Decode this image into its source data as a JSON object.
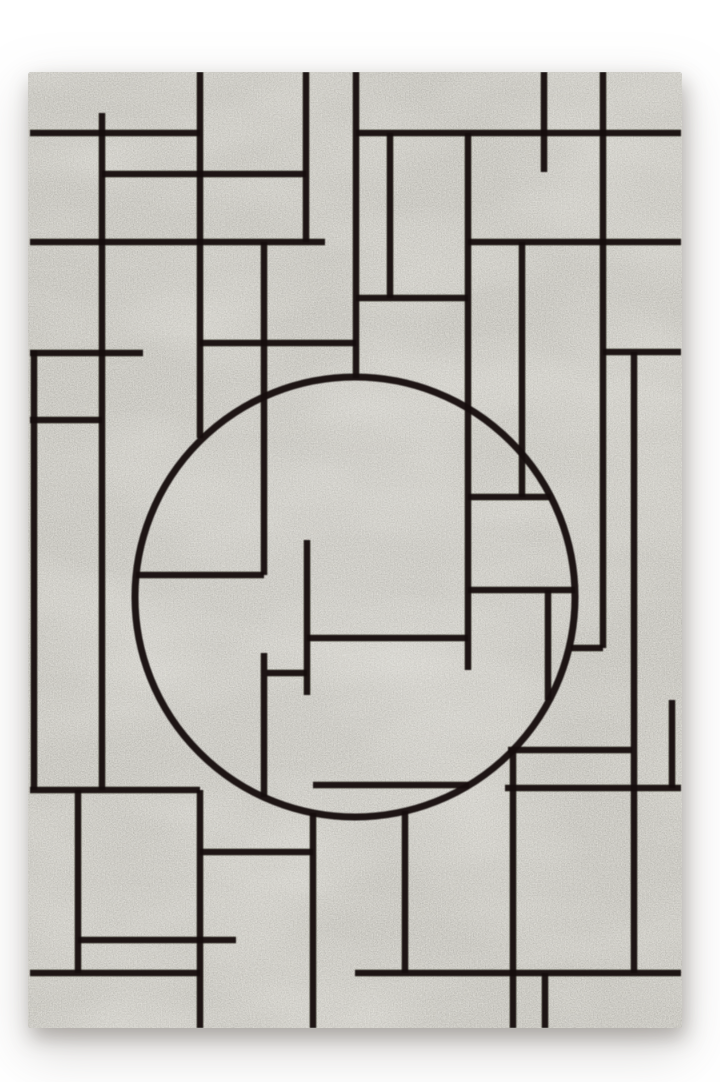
{
  "image": {
    "kind": "product-photo",
    "subject": "gray heathered area rug with black abstract line grid and central circle motif",
    "background_color": "#ffffff"
  },
  "palette": {
    "rug_base": "#96928a",
    "rug_light": "#b9b5ac",
    "rug_dark": "#6e6a63",
    "line_color": "#16120e",
    "shadow": "rgba(88,80,72,0.38)"
  },
  "rug": {
    "x": 28,
    "y": 72,
    "width": 654,
    "height": 956,
    "corner_radius": 3,
    "line_width": 6.5,
    "circle": {
      "cx": 355,
      "cy": 597,
      "r": 220,
      "stroke_width": 7
    },
    "highlight": {
      "cx": 330,
      "cy": 590,
      "r": 300,
      "opacity": 0.1
    },
    "lines": [
      {
        "x1": 30,
        "y1": 133,
        "x2": 200,
        "y2": 133
      },
      {
        "x1": 356,
        "y1": 133,
        "x2": 681,
        "y2": 133
      },
      {
        "x1": 102,
        "y1": 174,
        "x2": 306,
        "y2": 174
      },
      {
        "x1": 30,
        "y1": 242,
        "x2": 325,
        "y2": 242
      },
      {
        "x1": 468,
        "y1": 242,
        "x2": 681,
        "y2": 242
      },
      {
        "x1": 356,
        "y1": 298,
        "x2": 468,
        "y2": 298
      },
      {
        "x1": 200,
        "y1": 343,
        "x2": 356,
        "y2": 343
      },
      {
        "x1": 30,
        "y1": 353,
        "x2": 143,
        "y2": 353
      },
      {
        "x1": 603,
        "y1": 352,
        "x2": 681,
        "y2": 352
      },
      {
        "x1": 30,
        "y1": 420,
        "x2": 102,
        "y2": 420
      },
      {
        "x1": 468,
        "y1": 497,
        "x2": 551,
        "y2": 497
      },
      {
        "x1": 136,
        "y1": 575,
        "x2": 264,
        "y2": 575
      },
      {
        "x1": 468,
        "y1": 590,
        "x2": 575,
        "y2": 590
      },
      {
        "x1": 307,
        "y1": 638,
        "x2": 468,
        "y2": 638
      },
      {
        "x1": 571,
        "y1": 648,
        "x2": 603,
        "y2": 648
      },
      {
        "x1": 267,
        "y1": 673,
        "x2": 307,
        "y2": 673
      },
      {
        "x1": 508,
        "y1": 750,
        "x2": 632,
        "y2": 750
      },
      {
        "x1": 313,
        "y1": 785,
        "x2": 469,
        "y2": 785
      },
      {
        "x1": 505,
        "y1": 788,
        "x2": 681,
        "y2": 788
      },
      {
        "x1": 30,
        "y1": 790,
        "x2": 200,
        "y2": 790
      },
      {
        "x1": 200,
        "y1": 852,
        "x2": 313,
        "y2": 852
      },
      {
        "x1": 78,
        "y1": 940,
        "x2": 236,
        "y2": 940
      },
      {
        "x1": 30,
        "y1": 973,
        "x2": 200,
        "y2": 973
      },
      {
        "x1": 355,
        "y1": 973,
        "x2": 681,
        "y2": 973
      },
      {
        "x1": 34,
        "y1": 350,
        "x2": 34,
        "y2": 790
      },
      {
        "x1": 78,
        "y1": 790,
        "x2": 78,
        "y2": 973
      },
      {
        "x1": 102,
        "y1": 113,
        "x2": 102,
        "y2": 790
      },
      {
        "x1": 200,
        "y1": 72,
        "x2": 200,
        "y2": 438
      },
      {
        "x1": 200,
        "y1": 790,
        "x2": 200,
        "y2": 1028
      },
      {
        "x1": 264,
        "y1": 242,
        "x2": 264,
        "y2": 575
      },
      {
        "x1": 264,
        "y1": 653,
        "x2": 264,
        "y2": 797
      },
      {
        "x1": 306,
        "y1": 72,
        "x2": 306,
        "y2": 242
      },
      {
        "x1": 307,
        "y1": 540,
        "x2": 307,
        "y2": 695
      },
      {
        "x1": 313,
        "y1": 813,
        "x2": 313,
        "y2": 1028
      },
      {
        "x1": 356,
        "y1": 72,
        "x2": 356,
        "y2": 378
      },
      {
        "x1": 390,
        "y1": 133,
        "x2": 390,
        "y2": 298
      },
      {
        "x1": 405,
        "y1": 811,
        "x2": 405,
        "y2": 973
      },
      {
        "x1": 468,
        "y1": 133,
        "x2": 468,
        "y2": 670
      },
      {
        "x1": 513,
        "y1": 750,
        "x2": 513,
        "y2": 1028
      },
      {
        "x1": 522,
        "y1": 242,
        "x2": 522,
        "y2": 497
      },
      {
        "x1": 544,
        "y1": 72,
        "x2": 544,
        "y2": 172
      },
      {
        "x1": 545,
        "y1": 973,
        "x2": 545,
        "y2": 1028
      },
      {
        "x1": 548,
        "y1": 590,
        "x2": 548,
        "y2": 700
      },
      {
        "x1": 603,
        "y1": 72,
        "x2": 603,
        "y2": 648
      },
      {
        "x1": 634,
        "y1": 352,
        "x2": 634,
        "y2": 973
      },
      {
        "x1": 672,
        "y1": 700,
        "x2": 672,
        "y2": 788
      }
    ]
  }
}
